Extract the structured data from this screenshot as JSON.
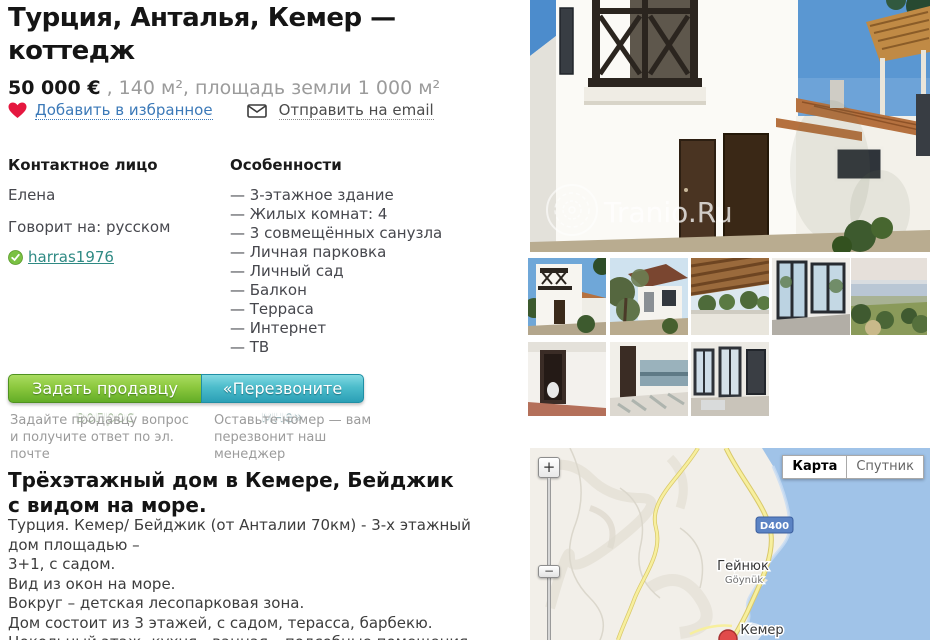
{
  "listing": {
    "title": "Турция, Анталья, Кемер — коттедж",
    "price": "50 000 €",
    "price_rest": " , 140 м², площадь земли 1 000 м²",
    "favorite": "Добавить в избранное",
    "email": "Отправить на email"
  },
  "contact": {
    "heading": "Контактное лицо",
    "name": "Елена",
    "speaks": "Говорит на: русском",
    "username": "harras1976"
  },
  "features": {
    "heading": "Особенности",
    "items": [
      "— 3-этажное здание",
      "— Жилых комнат: 4",
      "— 3 совмещённых санузла",
      "— Личная парковка",
      "— Личный сад",
      "— Балкон",
      "— Терраса",
      "— Интернет",
      "— ТВ"
    ]
  },
  "actions": {
    "ask": "Задать продавцу вопрос",
    "callback": "«Перезвоните мне»",
    "ask_hint": "Задайте продавцу вопрос и получите ответ по эл. почте",
    "callback_hint": "Оставьте номер — вам перезвонит наш менеджер"
  },
  "description": {
    "heading": "Трёхэтажный дом в Кемере, Бейджик с видом на море.",
    "text": "Турция. Кемер/ Бейджик (от Анталии 70км) - 3-х этажный дом площадью –\n3+1, с садом.\nВид из окон на море.\nВокруг – детская лесопарковая зона.\nДом состоит из 3 этажей, с садом, терасса, барбекю.\nЦокольный этаж -кухня - ванная – подсобные помещения.\n1-й этаж – 1салон – 1спальная комната - туалет."
  },
  "photo": {
    "watermark": "Tranio.Ru"
  },
  "thumbnails": [
    "exterior-front",
    "exterior-garden",
    "terrace-view",
    "interior-windows",
    "landscape-view",
    "interior-room",
    "kitchen",
    "interior-doors"
  ],
  "map": {
    "btn_map": "Карта",
    "btn_satellite": "Спутник",
    "road_badge": "D400",
    "city_ru": "Гейнюк",
    "city_lat": "Göynük",
    "city2": "Кемер",
    "zoom_in": "+",
    "zoom_out": "−"
  },
  "colors": {
    "heart_red": "#e5173f",
    "link_blue": "#3b79b8",
    "user_teal": "#2f8a84",
    "btn_green": "#63ad27",
    "btn_teal": "#2ba0b6",
    "map_water": "#a0c3e8",
    "map_land": "#f2efe9",
    "road_yellow": "#f1e28a",
    "pin_red": "#e14b4b"
  }
}
